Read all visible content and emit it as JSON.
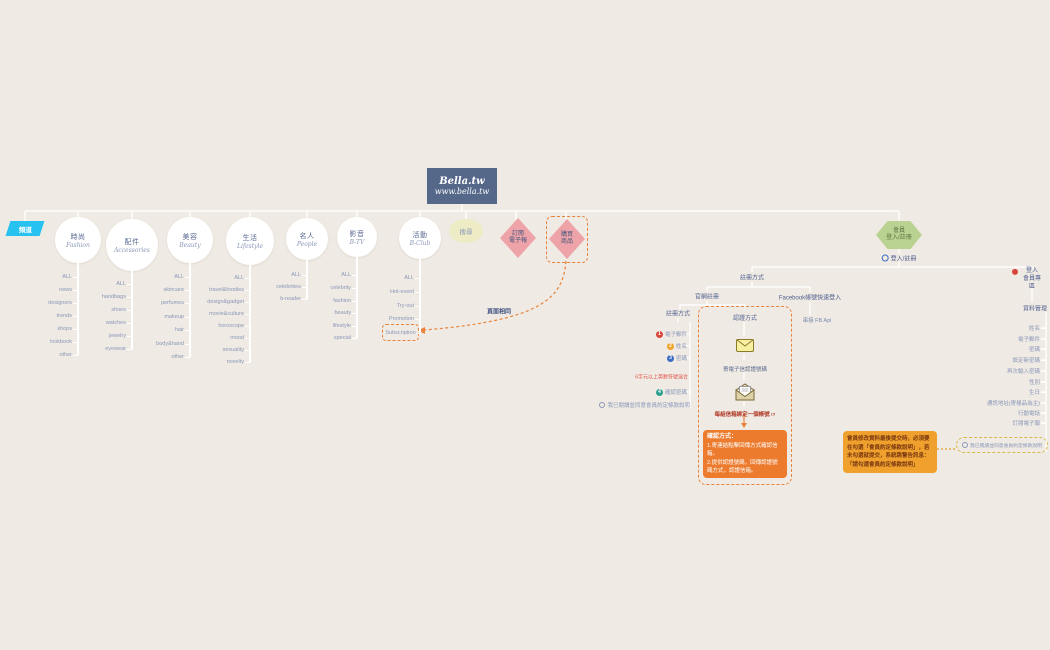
{
  "root": {
    "title": "Bella.tw",
    "subtitle": "www.bella.tw"
  },
  "row_label": "頻道",
  "channels": [
    {
      "zh": "時尚",
      "en": "Fashion",
      "items": [
        "ALL",
        "news",
        "designers",
        "trends",
        "shops",
        "lookbook",
        "other"
      ]
    },
    {
      "zh": "配件",
      "en": "Accessories",
      "items": [
        "ALL",
        "handbags",
        "shoes",
        "watches",
        "jewelry",
        "eyewear"
      ]
    },
    {
      "zh": "美容",
      "en": "Beauty",
      "items": [
        "ALL",
        "skincare",
        "perfumes",
        "makeup",
        "hair",
        "body&hand",
        "other"
      ]
    },
    {
      "zh": "生活",
      "en": "Lifestyle",
      "items": [
        "ALL",
        "travel&foodies",
        "design&gadget",
        "movie&culture",
        "horoscope",
        "mood",
        "sexuality",
        "novelty"
      ]
    },
    {
      "zh": "名人",
      "en": "People",
      "items": [
        "ALL",
        "celebrities",
        "b-reader"
      ]
    },
    {
      "zh": "影音",
      "en": "B-TV",
      "items": [
        "ALL",
        "celebrity",
        "fashion",
        "beauty",
        "lifestyle",
        "special"
      ]
    },
    {
      "zh": "活動",
      "en": "B-Club",
      "items": [
        "ALL",
        "Hot-event",
        "Try-out",
        "Promotion",
        "Subscription"
      ]
    }
  ],
  "top_nodes": {
    "search": "搜尋",
    "subscribe": [
      "訂閱",
      "電子報"
    ],
    "purchase": [
      "購買",
      "商品"
    ]
  },
  "same_page": "頁面相同",
  "member": {
    "hexagon": [
      "會員",
      "登入/註冊"
    ],
    "login_register": "登入/註冊",
    "register_method": "註冊方式",
    "official": "官網註冊",
    "facebook": "Facebook帳號快速登入",
    "fb_api": "串接 FB Api",
    "fields_title": "註冊方式",
    "fields": [
      {
        "label": "電子郵件",
        "color": "#d9453a"
      },
      {
        "label": "姓名",
        "color": "#f0a32a"
      },
      {
        "label": "密碼",
        "color": "#3a6cc4"
      },
      {
        "label": "確認密碼",
        "color": "#2a9e8f"
      }
    ],
    "password_hint": "6字元以上英數符號混合",
    "agree": "我已閱讀並同意會員約定條款說明",
    "verify": {
      "title": "認證方式",
      "step1": "寄電子信認證號碼",
      "step2": "每組信箱綁定一個帳號",
      "mark": "!?"
    },
    "confirm": {
      "title": "確認方式：",
      "line1": "1.寄連結點擊回傳方式確認信箱。",
      "line2": "2.提供認證號碼，回傳認證號碼方式，認證信箱。"
    },
    "login_area": [
      "登入",
      "會員專區"
    ],
    "data_title": "資料管理",
    "data_items": [
      "姓名",
      "電子郵件",
      "密碼",
      "設定新密碼",
      "再次輸入密碼",
      "性別",
      "生日",
      "通訊地址(寄樣品為主)",
      "行動電話",
      "訂閱電子報"
    ],
    "data_agree": "我已閱讀並同意會員約定條款說明",
    "note": "會員修改資料最後提交時，必須要在勾選「會員約定條款說明」，若未勾選就提交，系統跳警告訊息：「請勾選會員約定條款說明」"
  },
  "colors": {
    "background": "#efeae3",
    "root_box": "#56688a",
    "parallelogram": "#27c2f0",
    "search_fill": "#eeecc5",
    "diamond_fill": "#eea3a8",
    "hexagon_fill": "#bad291",
    "wire": "#ffffff",
    "dashed_orange": "#e8833c",
    "confirm_box": "#ec7b2e",
    "note_box": "#f0a02c",
    "hint_red": "#e0544a"
  }
}
